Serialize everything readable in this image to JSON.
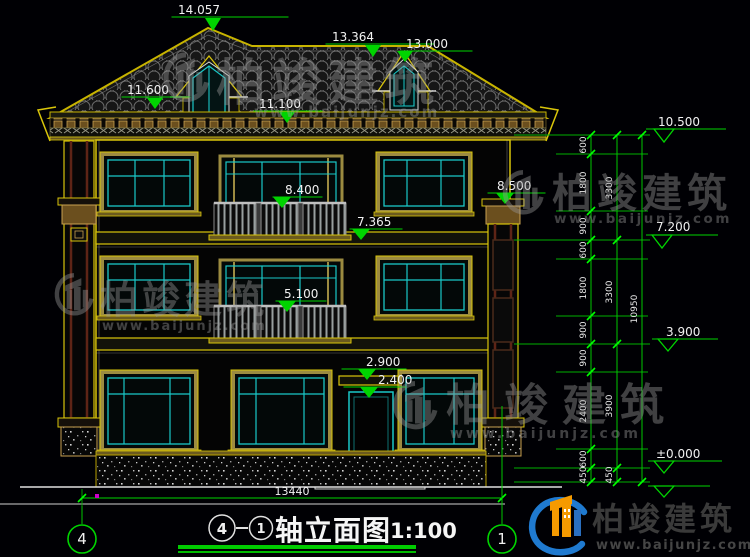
{
  "drawing_title": {
    "axis_from": "4",
    "connector": "—",
    "axis_to": "1",
    "name": "轴立面图",
    "scale": "1:100"
  },
  "axes": {
    "left": "4",
    "right": "1"
  },
  "levels": {
    "ridge": "14.057",
    "secondary_ridge": "13.364",
    "dormer_peak": "13.000",
    "dormer_eave": "11.600",
    "main_eave": "11.100",
    "f3_rail": "8.400",
    "column_capital": "8.500",
    "f3_floor": "7.365",
    "f2_rail": "5.100",
    "canopy": "2.900",
    "door_head": "2.400",
    "eave_right": "10.500",
    "f3_right": "7.200",
    "f2_right": "3.900",
    "zero": "±0.000"
  },
  "dims": {
    "overall_width": "13440",
    "total_height": "10950",
    "inner_chain": [
      "600",
      "1800",
      "900",
      "600",
      "1800",
      "900",
      "900",
      "2400",
      "600",
      "450"
    ],
    "floor_chain": [
      "3300",
      "3300",
      "3900",
      "450"
    ]
  },
  "watermark": {
    "brand": "柏竣建筑",
    "site": "www.baijunjz.com"
  },
  "logo": {
    "brand": "柏竣建筑",
    "site": "www.baijunjz.com"
  },
  "colors": {
    "background": "#000004",
    "dim_green": "#00d400",
    "wall_yellow": "#d9c50a",
    "window_cyan": "#1ac8c8",
    "frame_olive": "#9c8b40",
    "dim_text": "#f2f2f2",
    "logo_blue": "#1f7ad0",
    "logo_orange": "#f59a00"
  }
}
